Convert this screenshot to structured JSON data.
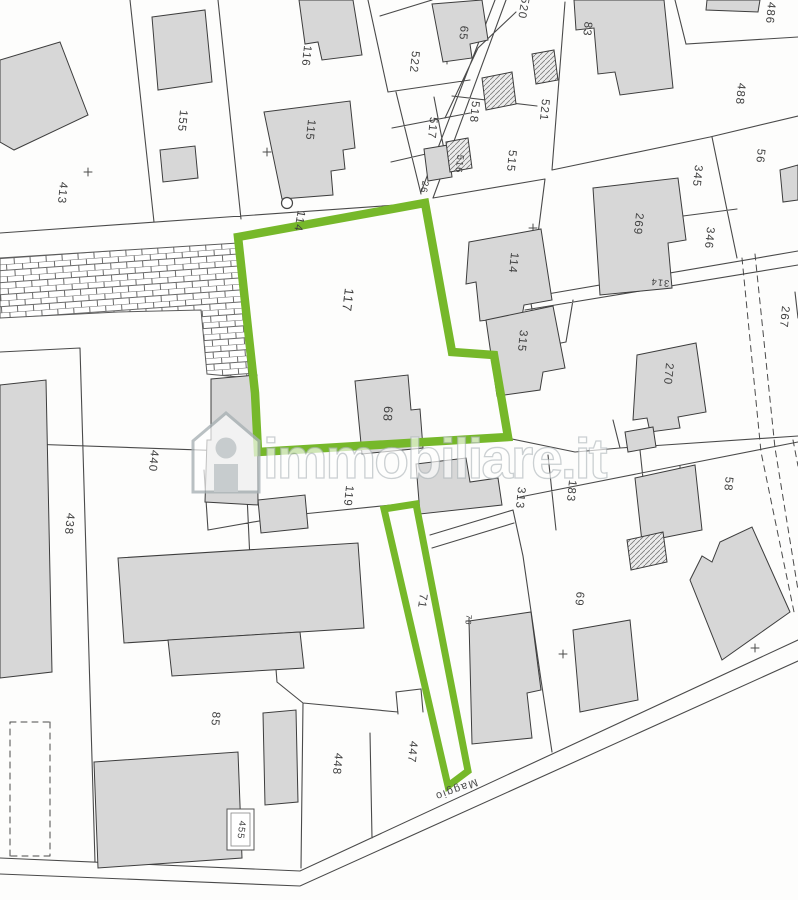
{
  "map": {
    "watermark": {
      "text": "immobiliare.it",
      "icon": "house-icon"
    },
    "highlighted_parcels": [
      "117",
      "68",
      "71"
    ],
    "street_label": "Maggio",
    "colors": {
      "highlight": "#76b82a",
      "line": "#4a4a4a",
      "building": "#d7d7d7",
      "hatch_line": "#7a7a7a",
      "watermark_outline": "#a9b2b5"
    },
    "labels": [
      {
        "text": "413"
      },
      {
        "text": "155"
      },
      {
        "text": "116"
      },
      {
        "text": "115"
      },
      {
        "text": "522"
      },
      {
        "text": "65"
      },
      {
        "text": "520"
      },
      {
        "text": "83"
      },
      {
        "text": "486"
      },
      {
        "text": "488"
      },
      {
        "text": "56"
      },
      {
        "text": "517"
      },
      {
        "text": "518"
      },
      {
        "text": "521"
      },
      {
        "text": "516"
      },
      {
        "text": "515"
      },
      {
        "text": "26"
      },
      {
        "text": "114"
      },
      {
        "text": "117"
      },
      {
        "text": "114"
      },
      {
        "text": "315"
      },
      {
        "text": "345"
      },
      {
        "text": "346"
      },
      {
        "text": "269"
      },
      {
        "text": "314"
      },
      {
        "text": "267"
      },
      {
        "text": "270"
      },
      {
        "text": "68"
      },
      {
        "text": "440"
      },
      {
        "text": "438"
      },
      {
        "text": "119"
      },
      {
        "text": "313"
      },
      {
        "text": "183"
      },
      {
        "text": "58"
      },
      {
        "text": "71"
      },
      {
        "text": "69"
      },
      {
        "text": "76"
      },
      {
        "text": "85"
      },
      {
        "text": "447"
      },
      {
        "text": "448"
      },
      {
        "text": "455"
      },
      {
        "text": "Maggio"
      }
    ]
  }
}
